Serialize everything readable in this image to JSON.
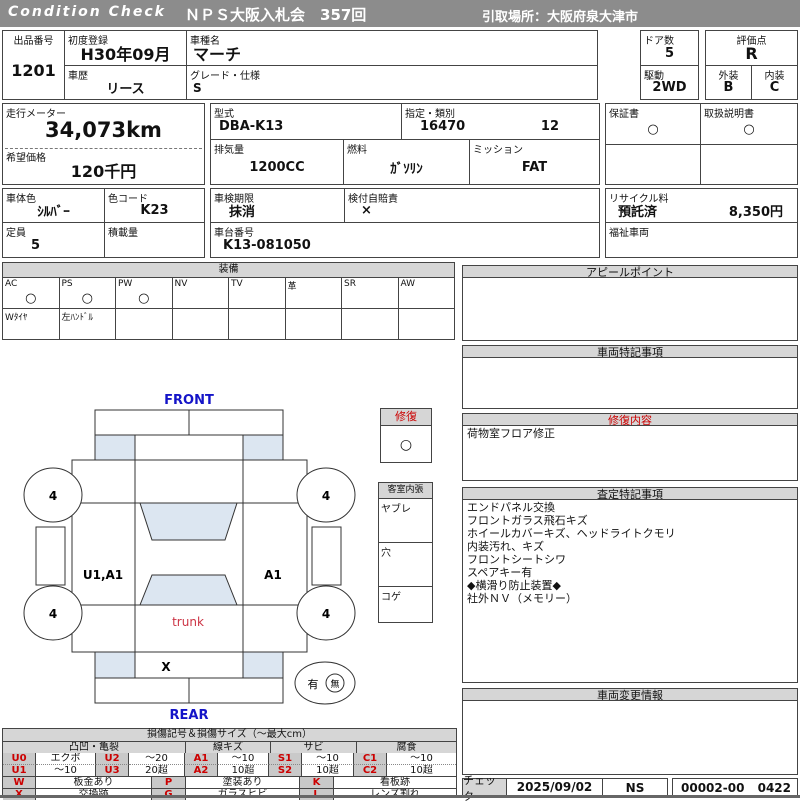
{
  "header": {
    "brand": "Condition  Check",
    "title": "ＮＰＳ大阪入札会　357回",
    "pickup": "引取場所：大阪府泉大津市"
  },
  "info": {
    "lot": {
      "label": "出品番号",
      "value": "1201"
    },
    "first_reg": {
      "label": "初度登録",
      "value": "H30年09月"
    },
    "history": {
      "label": "車歴",
      "value": "リース"
    },
    "model_name": {
      "label": "車種名",
      "value": "マーチ"
    },
    "grade": {
      "label": "グレード・仕様",
      "value": "S"
    },
    "doors": {
      "label": "ドア数",
      "value": "5"
    },
    "drive": {
      "label": "駆動",
      "value": "2WD"
    },
    "score": {
      "label": "評価点",
      "value": "R"
    },
    "exterior": {
      "label": "外装",
      "value": "B"
    },
    "interior": {
      "label": "内装",
      "value": "C"
    },
    "odometer": {
      "label": "走行メーター",
      "value": "34,073km"
    },
    "price": {
      "label": "希望価格",
      "value": "120千円"
    },
    "model_code": {
      "label": "型式",
      "value": "DBA-K13"
    },
    "designation": {
      "label": "指定・類別",
      "value1": "16470",
      "value2": "12"
    },
    "displacement": {
      "label": "排気量",
      "value": "1200CC"
    },
    "fuel": {
      "label": "燃料",
      "value": "ｶﾞｿﾘﾝ"
    },
    "mission": {
      "label": "ミッション",
      "value": "FAT"
    },
    "warranty": {
      "label": "保証書",
      "value": "○"
    },
    "manual": {
      "label": "取扱説明書",
      "value": "○"
    },
    "body_color": {
      "label": "車体色",
      "value": "ｼﾙﾊﾞｰ"
    },
    "color_code": {
      "label": "色コード",
      "value": "K23"
    },
    "inspection": {
      "label": "車検期限",
      "value": "抹消"
    },
    "insurance": {
      "label": "検付自賠責",
      "value": "×"
    },
    "recycle": {
      "label": "リサイクル料",
      "status": "預託済",
      "amount": "8,350円"
    },
    "capacity": {
      "label": "定員",
      "value": "5"
    },
    "payload": {
      "label": "積載量",
      "value": ""
    },
    "chassis": {
      "label": "車台番号",
      "value": "K13-081050"
    },
    "welfare": {
      "label": "福祉車両",
      "value": ""
    }
  },
  "equipment": {
    "title": "装備",
    "items": [
      {
        "label": "AC",
        "value": "○",
        "note": "Wﾀｲﾔ"
      },
      {
        "label": "PS",
        "value": "○",
        "note": "左ﾊﾝﾄﾞﾙ"
      },
      {
        "label": "PW",
        "value": "○",
        "note": ""
      },
      {
        "label": "NV",
        "value": "",
        "note": ""
      },
      {
        "label": "TV",
        "value": "",
        "note": ""
      },
      {
        "label": "革",
        "value": "",
        "note": ""
      },
      {
        "label": "SR",
        "value": "",
        "note": ""
      },
      {
        "label": "AW",
        "value": "",
        "note": ""
      }
    ]
  },
  "diagram": {
    "front": "FRONT",
    "rear": "REAR",
    "trunk": "trunk",
    "wheel1": "4",
    "wheel2": "4",
    "wheel3": "4",
    "wheel4": "4",
    "left_panel_mark": "U1,A1",
    "right_panel_mark": "A1",
    "rear_panel_mark": "X",
    "spare_yes": "有",
    "spare_no": "無",
    "repair": {
      "label": "修復",
      "value": "○"
    },
    "cabin": {
      "label": "客室内張",
      "rows": [
        "ヤブレ",
        "穴",
        "コゲ"
      ]
    }
  },
  "sections": {
    "appeal": {
      "title": "アピールポイント",
      "content": ""
    },
    "vehicle_notes": {
      "title": "車両特記事項",
      "content": ""
    },
    "repair_detail": {
      "title": "修復内容",
      "content": "荷物室フロア修正"
    },
    "assessment": {
      "title": "査定特記事項",
      "lines": [
        "エンドパネル交換",
        "フロントガラス飛石キズ",
        "ホイールカバーキズ、ヘッドライトクモリ",
        "内装汚れ、キズ",
        "フロントシートシワ",
        "スペアキー有",
        "◆横滑り防止装置◆",
        "社外ＮＶ（メモリー）"
      ]
    },
    "change_info": {
      "title": "車両変更情報",
      "content": ""
    },
    "check": {
      "label": "チェック",
      "date": "2025/09/02",
      "inspector": "NS",
      "code1": "00002-00",
      "code2": "0422"
    }
  },
  "legend": {
    "title": "損傷記号＆損傷サイズ（～最大cm）",
    "groups": [
      "凸凹・亀裂",
      "線キズ",
      "サビ",
      "腐食"
    ],
    "row1": [
      "U0",
      "エクボ",
      "U2",
      "～20",
      "A1",
      "～10",
      "S1",
      "～10",
      "C1",
      "～10"
    ],
    "row2": [
      "U1",
      "～10",
      "U3",
      "20超",
      "A2",
      "10超",
      "S2",
      "10超",
      "C2",
      "10超"
    ],
    "row3": [
      "W",
      "板金あり",
      "P",
      "塗装あり",
      "K",
      "看板跡"
    ],
    "row4": [
      "X",
      "交換跡",
      "G",
      "ガラスヒビ",
      "L",
      "レンズ割れ"
    ]
  },
  "colors": {
    "accent_red": "#cc0000",
    "label_blue": "#1414c8",
    "glass_blue": "#dce6f1",
    "bar_gray": "#8c8c8c",
    "cell_gray": "#d6d6d6"
  }
}
